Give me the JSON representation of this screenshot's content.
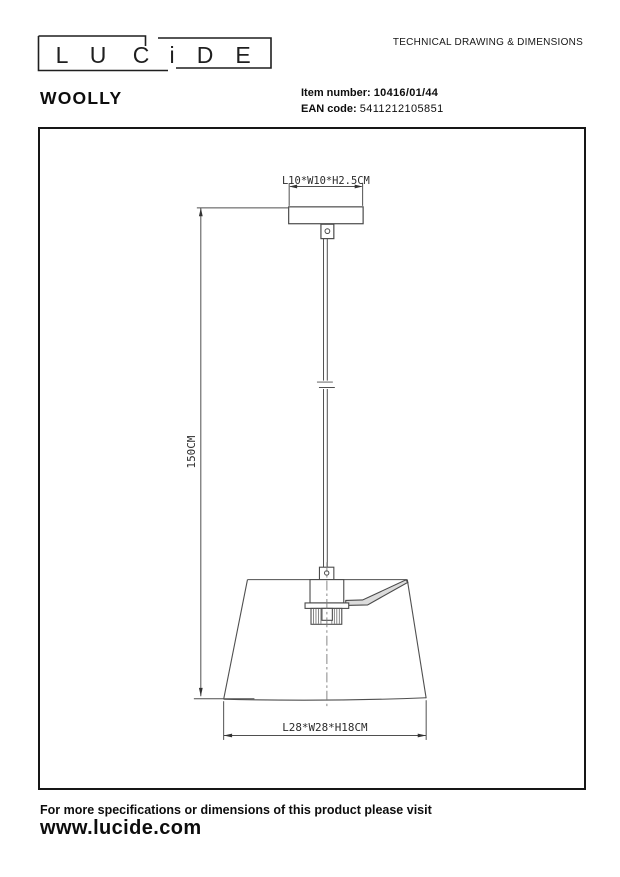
{
  "header": {
    "logo": {
      "name": "LUCIDE",
      "letters": [
        "L",
        "U",
        "C",
        "i",
        "D",
        "E"
      ]
    },
    "doc_title": "TECHNICAL DRAWING & DIMENSIONS",
    "product_name": "WOOLLY",
    "item_number_label": "Item number:",
    "item_number_value": "10416/01/44",
    "ean_label": "EAN code:",
    "ean_value": "5411212105851"
  },
  "drawing": {
    "canopy_dimension_label": "L10*W10*H2.5CM",
    "cable_length_label": "150CM",
    "shade_dimension_label": "L28*W28*H18CM"
  },
  "footer": {
    "note": "For more specifications or dimensions of this product please visit",
    "website": "www.lucide.com"
  },
  "colors": {
    "drawing_line": "#4f4f4f",
    "ink": "#111111"
  }
}
